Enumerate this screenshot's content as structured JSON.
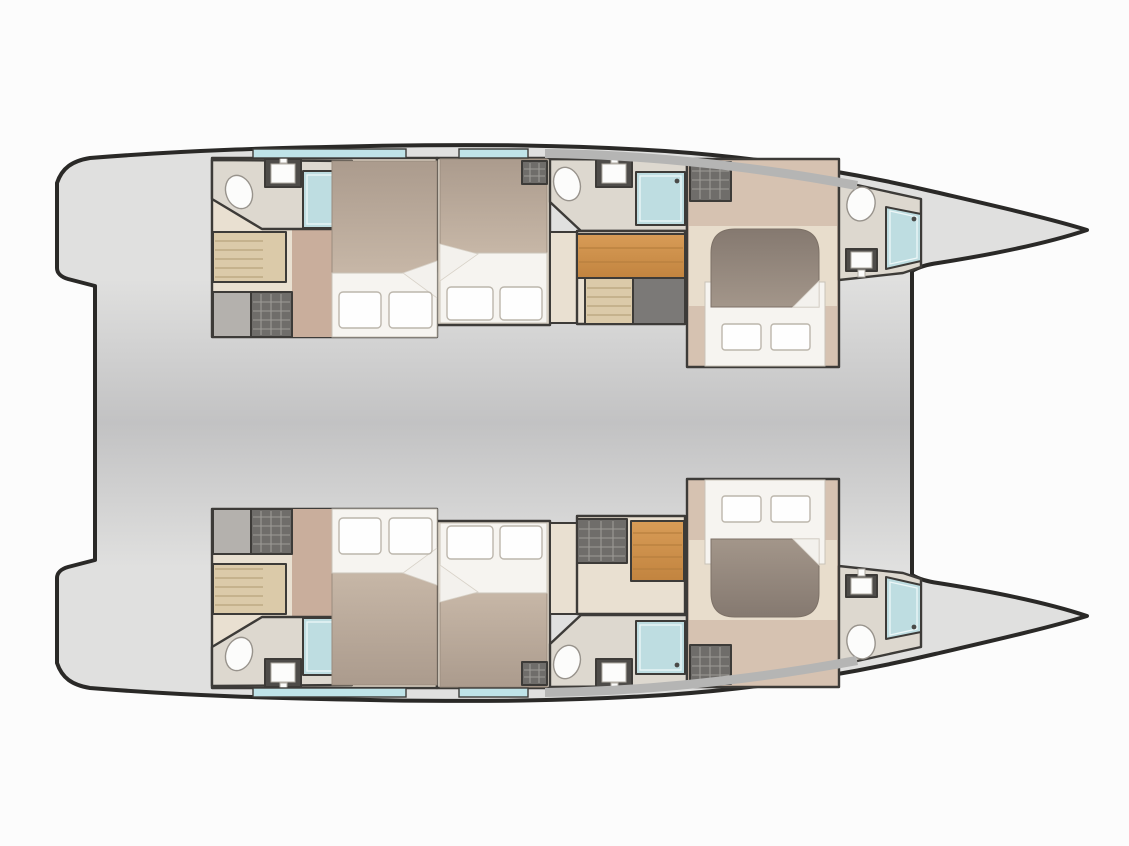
{
  "page": {
    "title": "Catamaran yacht floor plan — cabin deck, top view, bows to the right",
    "background": "#fcfcfc"
  },
  "colors": {
    "bg": "#fcfcfc",
    "outline": "#2a2927",
    "wall": "#3d3b38",
    "deck_light": "#e0e0df",
    "deck_mid": "#c2c2c3",
    "floor_beige": "#e9e0d1",
    "floor_rose": "#d6c2b1",
    "rose_strip": "#c9ae9c",
    "bath_floor": "#ddd8cf",
    "platform": "#e8ddcc",
    "shower": "#bedde1",
    "shower_glass": "#edf7f8",
    "window": "#bfe3e8",
    "edge_band": "#b5b5b4",
    "wood": "#d89c57",
    "wood_b": "#c2843f",
    "wood_line": "#b77f3e",
    "wood_light": "#dbcaa9",
    "step_line": "#b8a37d",
    "locker_dark": "#6f6d6a",
    "locker_grid": "#9d9a96",
    "locker_gray": "#b4b1ad",
    "landing": "#7b7977",
    "duvet_a": "#ab9b8d",
    "duvet_b": "#c7b7a7",
    "fore_duvet_a": "#857970",
    "fore_duvet_b": "#a3968a",
    "sheet": "#f6f4f0",
    "fold": "#f3f1ed",
    "pillow": "#fefefe",
    "pillow_edge": "#bcb6ac",
    "fixture_edge": "#98938c",
    "sink_counter": "#4e4c49",
    "porcelain": "#fcfcfb"
  },
  "diagram": {
    "type": "floor-plan",
    "subject": "sailing catamaran cabin deck seen from above, pointed bows to the right, stepped transoms to the left",
    "deck_areas": [
      "bridge deck between the hulls",
      "aft transom platform with recess",
      "foredeck notch between the bows"
    ],
    "counts": {
      "hulls": 2,
      "double_cabins": 6,
      "bathrooms": 6,
      "shower_stalls": 6,
      "companionway_stairs": 2,
      "wardrobe_lockers": 8
    },
    "hulls": [
      {
        "name": "port hull (top)",
        "rooms": [
          "aft bathroom with toilet, sink and glass shower",
          "aft double cabin with duvet bed and two pillows",
          "mid double cabin with duvet bed and two pillows",
          "mid bathroom with toilet, sink and glass shower",
          "central companionway stairs with landing",
          "forward double cabin with rounded island bed",
          "forward bow bathroom with toilet, sink and glass shower",
          "hatched wardrobe lockers and aft steps",
          "two hull windows on the outboard side"
        ]
      },
      {
        "name": "starboard hull (bottom)",
        "rooms": [
          "aft bathroom with toilet, sink and glass shower",
          "aft double cabin with duvet bed and two pillows",
          "mid double cabin with duvet bed and two pillows",
          "mid bathroom with toilet, sink and glass shower",
          "central companionway stairs with hatched locker",
          "forward double cabin with rounded island bed",
          "forward bow bathroom with toilet, sink and glass shower",
          "hatched wardrobe lockers and aft steps",
          "two hull windows on the outboard side"
        ]
      }
    ]
  }
}
